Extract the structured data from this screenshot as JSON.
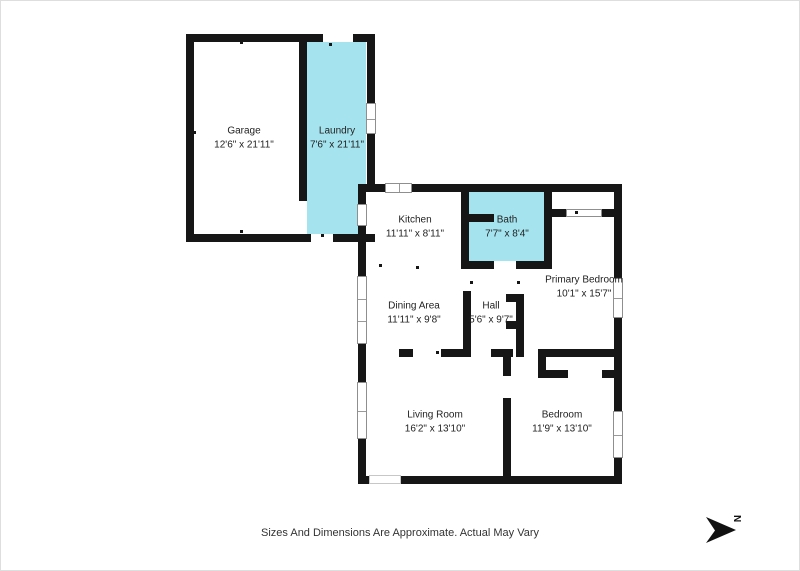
{
  "colors": {
    "wall": "#161616",
    "highlight": "#a5e4ef",
    "window_border": "#8f8f8f",
    "door_border": "#c7c7c7",
    "text": "#222222"
  },
  "rooms": [
    {
      "id": "garage",
      "name": "Garage",
      "dims": "12'6\" x 21'11\"",
      "cx": 243,
      "cy": 137,
      "highlighted": false
    },
    {
      "id": "laundry",
      "name": "Laundry",
      "dims": "7'6\" x 21'11\"",
      "cx": 336,
      "cy": 137,
      "highlighted": true
    },
    {
      "id": "kitchen",
      "name": "Kitchen",
      "dims": "11'11\" x 8'11\"",
      "cx": 414,
      "cy": 226,
      "highlighted": false
    },
    {
      "id": "bath",
      "name": "Bath",
      "dims": "7'7\" x 8'4\"",
      "cx": 506,
      "cy": 226,
      "highlighted": true
    },
    {
      "id": "dining-area",
      "name": "Dining Area",
      "dims": "11'11\" x 9'8\"",
      "cx": 413,
      "cy": 312,
      "highlighted": false
    },
    {
      "id": "hall",
      "name": "Hall",
      "dims": "5'6\" x 9'7\"",
      "cx": 490,
      "cy": 312,
      "highlighted": false
    },
    {
      "id": "primary-bedroom",
      "name": "Primary Bedroom",
      "dims": "10'1\" x 15'7\"",
      "cx": 583,
      "cy": 286,
      "highlighted": false
    },
    {
      "id": "living-room",
      "name": "Living Room",
      "dims": "16'2\" x 13'10\"",
      "cx": 434,
      "cy": 421,
      "highlighted": false
    },
    {
      "id": "bedroom",
      "name": "Bedroom",
      "dims": "11'9\" x 13'10\"",
      "cx": 561,
      "cy": 421,
      "highlighted": false
    }
  ],
  "disclaimer": "Sizes And Dimensions Are Approximate. Actual May Vary",
  "compass": {
    "letter": "N"
  },
  "plan": {
    "fills": [
      [
        306,
        41,
        59,
        192
      ],
      [
        468,
        191,
        75,
        69
      ]
    ],
    "walls": [
      [
        185,
        33,
        137,
        8
      ],
      [
        352,
        33,
        22,
        8
      ],
      [
        185,
        33,
        8,
        208
      ],
      [
        185,
        233,
        125,
        8
      ],
      [
        332,
        233,
        42,
        8
      ],
      [
        366,
        33,
        8,
        69
      ],
      [
        366,
        133,
        8,
        58
      ],
      [
        298,
        41,
        8,
        159
      ],
      [
        357,
        183,
        28,
        8
      ],
      [
        411,
        183,
        210,
        8
      ],
      [
        357,
        183,
        8,
        20
      ],
      [
        357,
        225,
        8,
        50
      ],
      [
        357,
        343,
        8,
        38
      ],
      [
        357,
        438,
        8,
        45
      ],
      [
        357,
        475,
        11,
        8
      ],
      [
        400,
        475,
        221,
        8
      ],
      [
        613,
        183,
        8,
        94
      ],
      [
        613,
        317,
        8,
        93
      ],
      [
        613,
        457,
        8,
        26
      ],
      [
        460,
        191,
        8,
        77
      ],
      [
        543,
        191,
        8,
        77
      ],
      [
        460,
        260,
        33,
        8
      ],
      [
        515,
        260,
        36,
        8
      ],
      [
        468,
        213,
        25,
        8
      ],
      [
        551,
        208,
        14,
        8
      ],
      [
        601,
        208,
        12,
        8
      ],
      [
        462,
        290,
        8,
        66
      ],
      [
        515,
        293,
        8,
        63
      ],
      [
        505,
        293,
        10,
        8
      ],
      [
        505,
        320,
        10,
        8
      ],
      [
        398,
        348,
        14,
        8
      ],
      [
        440,
        348,
        30,
        8
      ],
      [
        490,
        348,
        22,
        8
      ],
      [
        537,
        348,
        84,
        8
      ],
      [
        502,
        356,
        8,
        19
      ],
      [
        502,
        397,
        8,
        78
      ],
      [
        537,
        356,
        8,
        21
      ],
      [
        537,
        369,
        30,
        8
      ],
      [
        601,
        369,
        12,
        8
      ]
    ],
    "windows": [
      {
        "x": 365,
        "y": 102,
        "w": 10,
        "h": 31,
        "p": [
          0.5
        ]
      },
      {
        "x": 384,
        "y": 182,
        "w": 27,
        "h": 10,
        "p": [
          0.5
        ]
      },
      {
        "x": 356,
        "y": 203,
        "w": 10,
        "h": 22,
        "p": []
      },
      {
        "x": 356,
        "y": 275,
        "w": 10,
        "h": 68,
        "p": [
          0.34,
          0.66
        ]
      },
      {
        "x": 356,
        "y": 381,
        "w": 10,
        "h": 57,
        "p": [
          0.5
        ]
      },
      {
        "x": 612,
        "y": 277,
        "w": 10,
        "h": 40,
        "p": [
          0.5
        ]
      },
      {
        "x": 612,
        "y": 410,
        "w": 10,
        "h": 47,
        "p": [
          0.5
        ]
      },
      {
        "x": 368,
        "y": 474,
        "w": 32,
        "h": 9,
        "p": [],
        "light": true
      },
      {
        "x": 565,
        "y": 208,
        "w": 36,
        "h": 8,
        "p": []
      }
    ],
    "ticks": [
      [
        240,
        41
      ],
      [
        193,
        131
      ],
      [
        240,
        230
      ],
      [
        329,
        43
      ],
      [
        321,
        234
      ],
      [
        436,
        188
      ],
      [
        583,
        188
      ],
      [
        379,
        264
      ],
      [
        416,
        266
      ],
      [
        470,
        281
      ],
      [
        517,
        281
      ],
      [
        436,
        351
      ],
      [
        573,
        351
      ],
      [
        575,
        211
      ],
      [
        616,
        333
      ],
      [
        429,
        476
      ],
      [
        522,
        476
      ]
    ]
  }
}
